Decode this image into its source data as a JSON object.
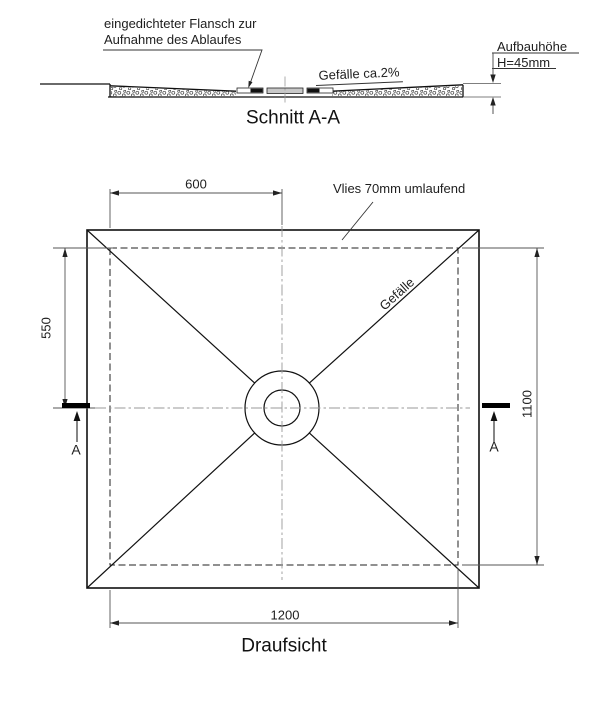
{
  "section_view": {
    "title": "Schnitt A-A",
    "flange_note_line1": "eingedichteter Flansch zur",
    "flange_note_line2": "Aufnahme des Ablaufes",
    "slope_note": "Gefälle ca.2%",
    "height_note_label": "Aufbauhöhe",
    "height_note_value": "H=45mm"
  },
  "plan_view": {
    "title": "Draufsicht",
    "fleece_note": "Vlies 70mm umlaufend",
    "slope_label": "Gefälle",
    "dim_top": "600",
    "dim_left": "550",
    "dim_right": "1100",
    "dim_bottom": "1200",
    "section_marker_left": "A",
    "section_marker_right": "A"
  },
  "colors": {
    "object_line": "#111111",
    "dimension_line": "#555555",
    "centerline": "#999999",
    "drain_plate": "#c8c8c8",
    "background": "#ffffff"
  }
}
